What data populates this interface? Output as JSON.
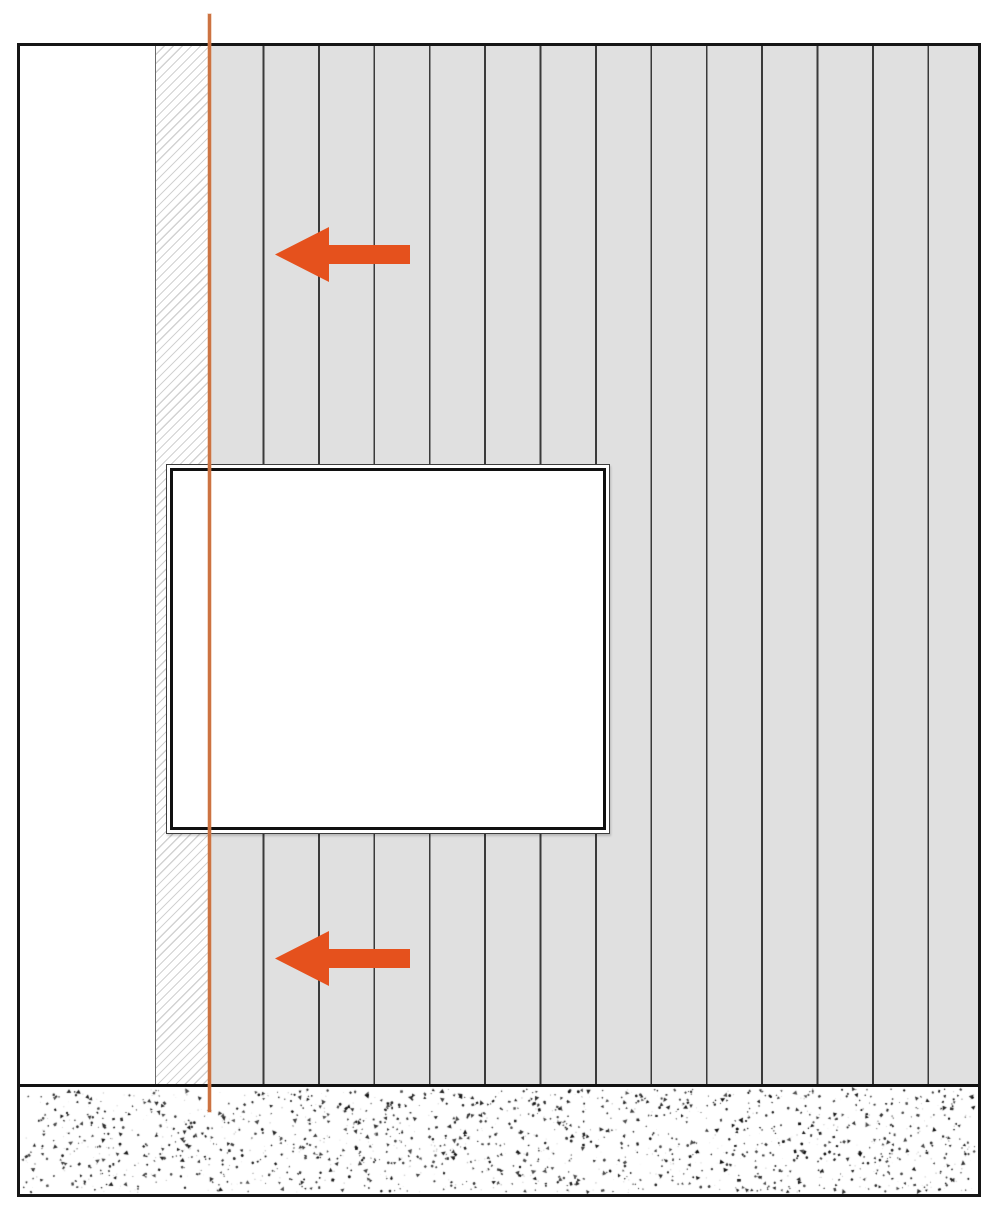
{
  "diagram": {
    "kind": "wallpapering-instruction-elevation",
    "colors": {
      "background": "#ffffff",
      "frame_border": "#161616",
      "wall_fill": "#e0e0e0",
      "seam_line": "#3a3a3a",
      "hatch_line": "#d2d2d2",
      "hatch_border": "#6b6b6b",
      "window_outer_border": "#3c3c3c",
      "window_inner_border": "#101010",
      "band_border": "#111111",
      "arrow": "#e5511d",
      "plumb_line": "#cc7342",
      "speckle_dark": "#0b0b0b",
      "speckle_light": "#a8a8a8"
    },
    "layout": {
      "diagram-frame": {
        "x": 17,
        "y": 43,
        "w": 964,
        "h": 1154
      },
      "corner-wall-white": {
        "x": 0,
        "y": 0,
        "w": 135,
        "h": 1038
      },
      "overlap-hatch-strip": {
        "x": 135,
        "y": 0,
        "w": 54,
        "h": 1038
      },
      "wallpaper-field": {
        "x": 189,
        "y": 0,
        "w": 769,
        "h": 1038
      },
      "window-opening": {
        "x": 146,
        "y": 418,
        "w": 444,
        "h": 370
      },
      "floor-screed-band": {
        "x": 0,
        "y": 1038,
        "w": 958,
        "h": 110
      },
      "plumb-line": {
        "x": 208,
        "y": 14,
        "w": 3,
        "h": 1098
      },
      "work-direction-arrow-upper": {
        "x": 275,
        "y": 227,
        "w": 135,
        "h": 55
      },
      "work-direction-arrow-lower": {
        "x": 275,
        "y": 931,
        "w": 135,
        "h": 55
      }
    },
    "wallpaper": {
      "seam_spacing": 55.4,
      "seam_width": 1.8
    },
    "hatch": {
      "period": 6.4,
      "line_width": 1.2,
      "angle_deg": 135
    },
    "arrows_meta": {
      "direction": "left",
      "head_w": 54,
      "head_h": 55,
      "shaft_h": 19
    },
    "speckle": {
      "dark_count": 1250,
      "light_count": 450,
      "seed": 42,
      "band_border_top": 3
    }
  }
}
